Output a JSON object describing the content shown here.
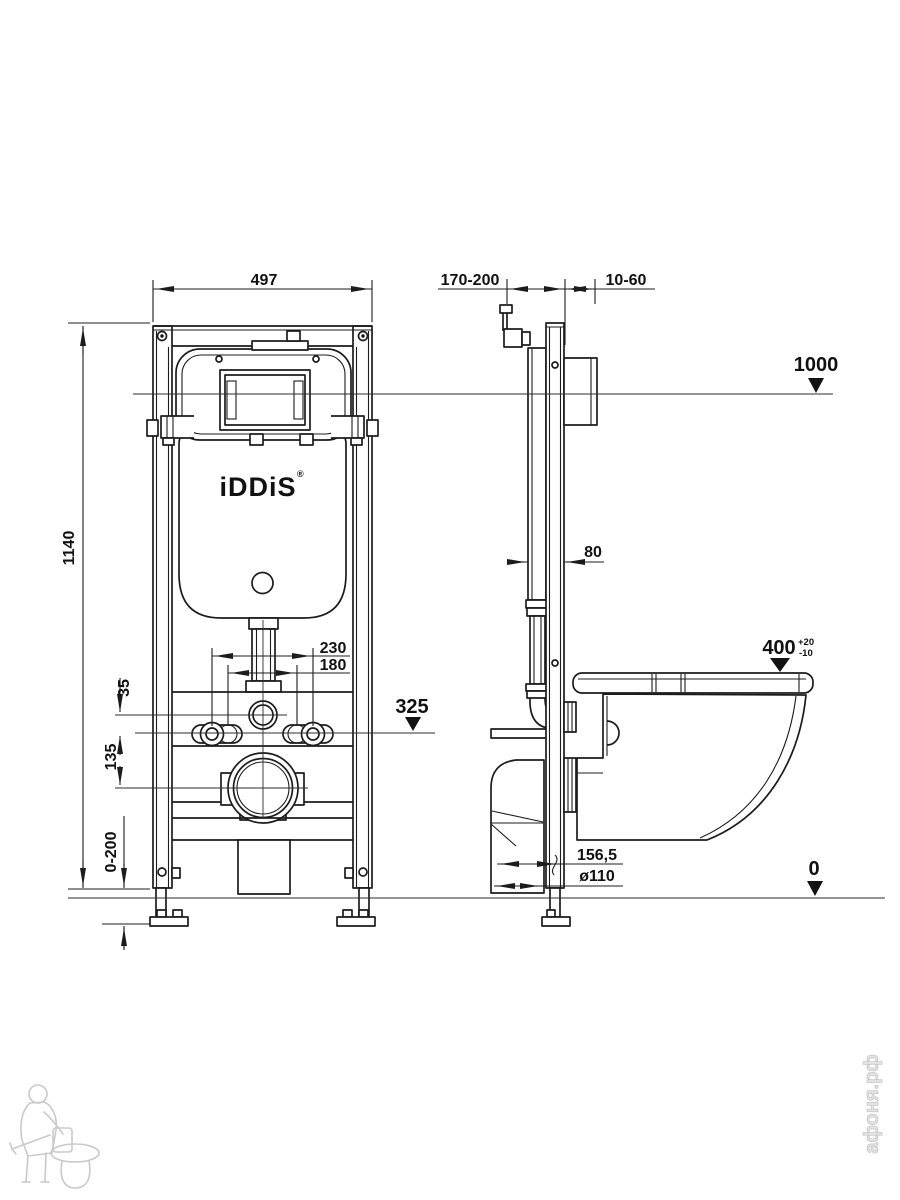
{
  "labels": {
    "width": "497",
    "height": "1140",
    "depth": "170-200",
    "cladding": "10-60",
    "level_top": "1000",
    "level_flush": "325",
    "level_seat": "400",
    "seat_tol_plus": "+20",
    "seat_tol_minus": "-10",
    "level_floor": "0",
    "bolt_outer": "230",
    "bolt_inner": "180",
    "inlet_offset": "35",
    "drain_offset": "135",
    "feet_range": "0-200",
    "pipe_offset": "80",
    "drain_proj": "156,5",
    "drain_dia": "ø110",
    "brand": "iDDiS",
    "brand_mark": "®",
    "watermark": "афоня.рф"
  },
  "colors": {
    "line": "#1c1c1c",
    "watermark": "#c9c9c9"
  }
}
